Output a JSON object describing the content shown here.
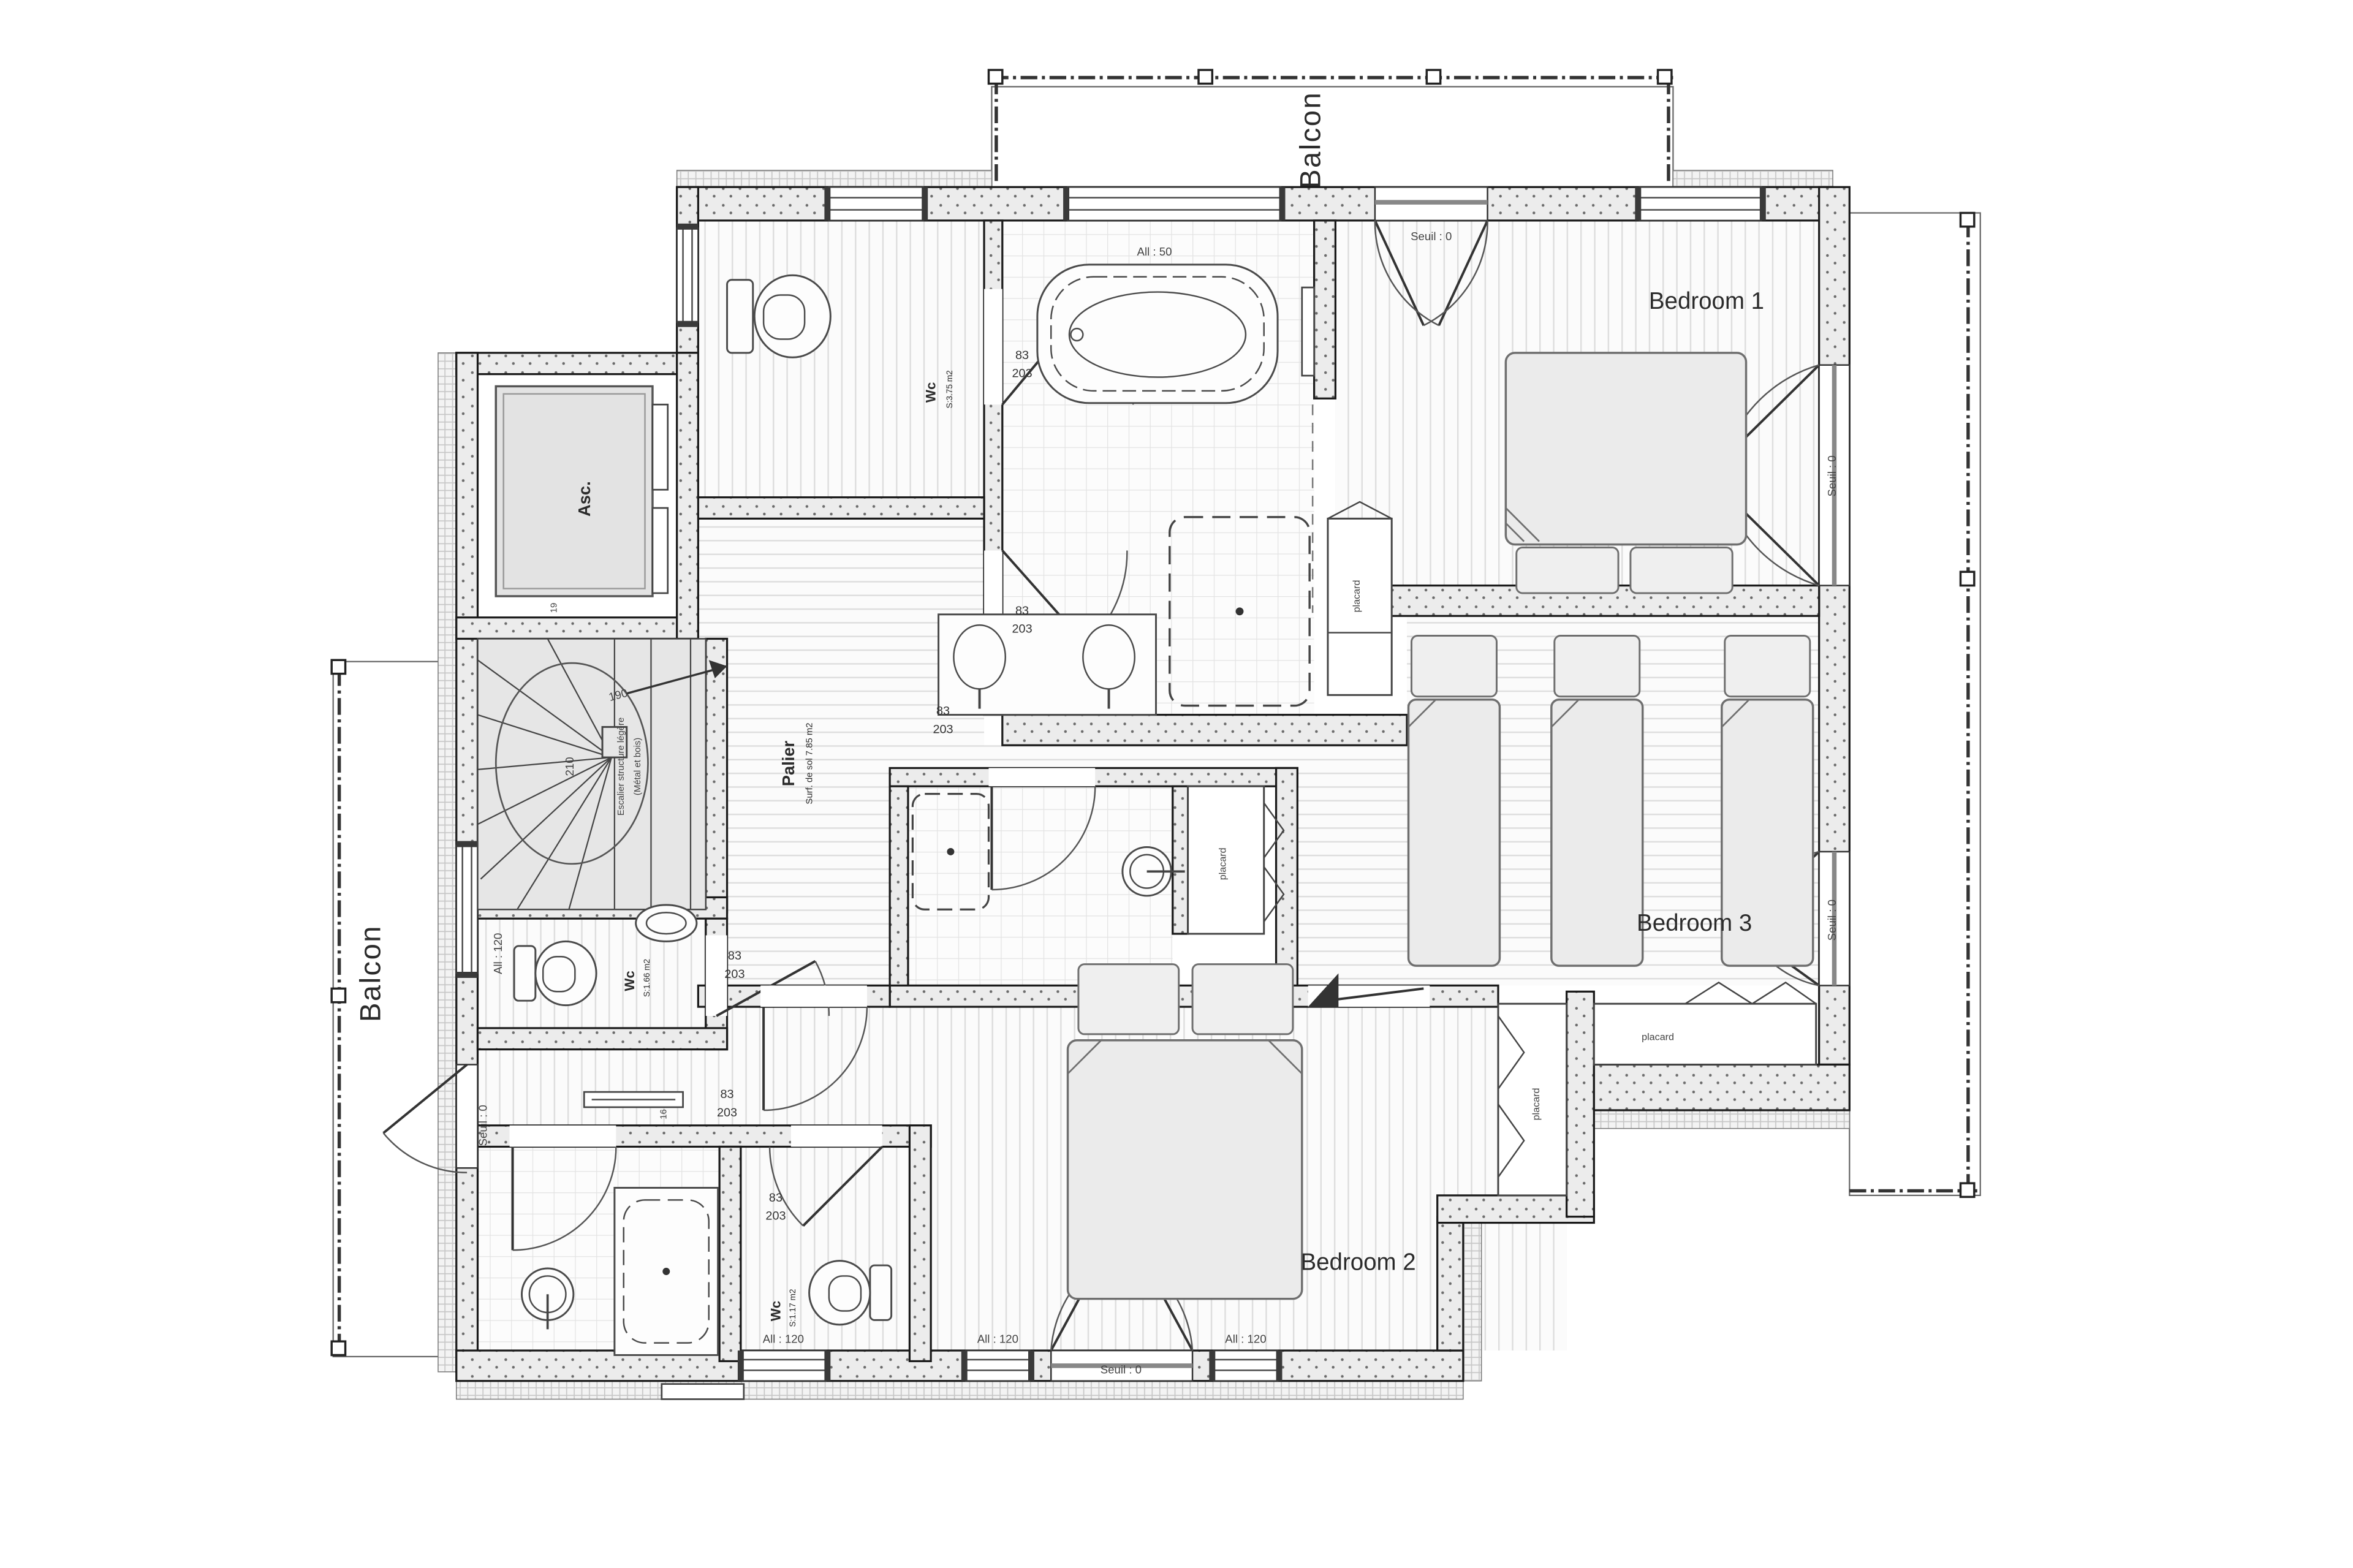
{
  "plan": {
    "rooms": {
      "bedroom1": "Bedroom 1",
      "bedroom2": "Bedroom 2",
      "bedroom3": "Bedroom 3",
      "palier": "Palier",
      "palier_area": "Surf. de sol 7.85 m2",
      "balcony": "Balcon",
      "elevator": "Asc.",
      "wc_name": "Wc",
      "wc1_area": "S:3.75 m2",
      "wc2_area": "S:1.66 m2",
      "wc3_area": "S:1.17 m2",
      "closet": "placard"
    },
    "stairs": {
      "note_line1": "Escalier structure légère",
      "note_line2": "(Métal et bois)",
      "going": "190",
      "rise": "210",
      "tread_16": "16",
      "tread_19": "19"
    },
    "annotations": {
      "threshold": "Seuil : 0",
      "sill_50": "All : 50",
      "sill_120": "All : 120",
      "door_width": "83",
      "door_height": "203"
    }
  }
}
